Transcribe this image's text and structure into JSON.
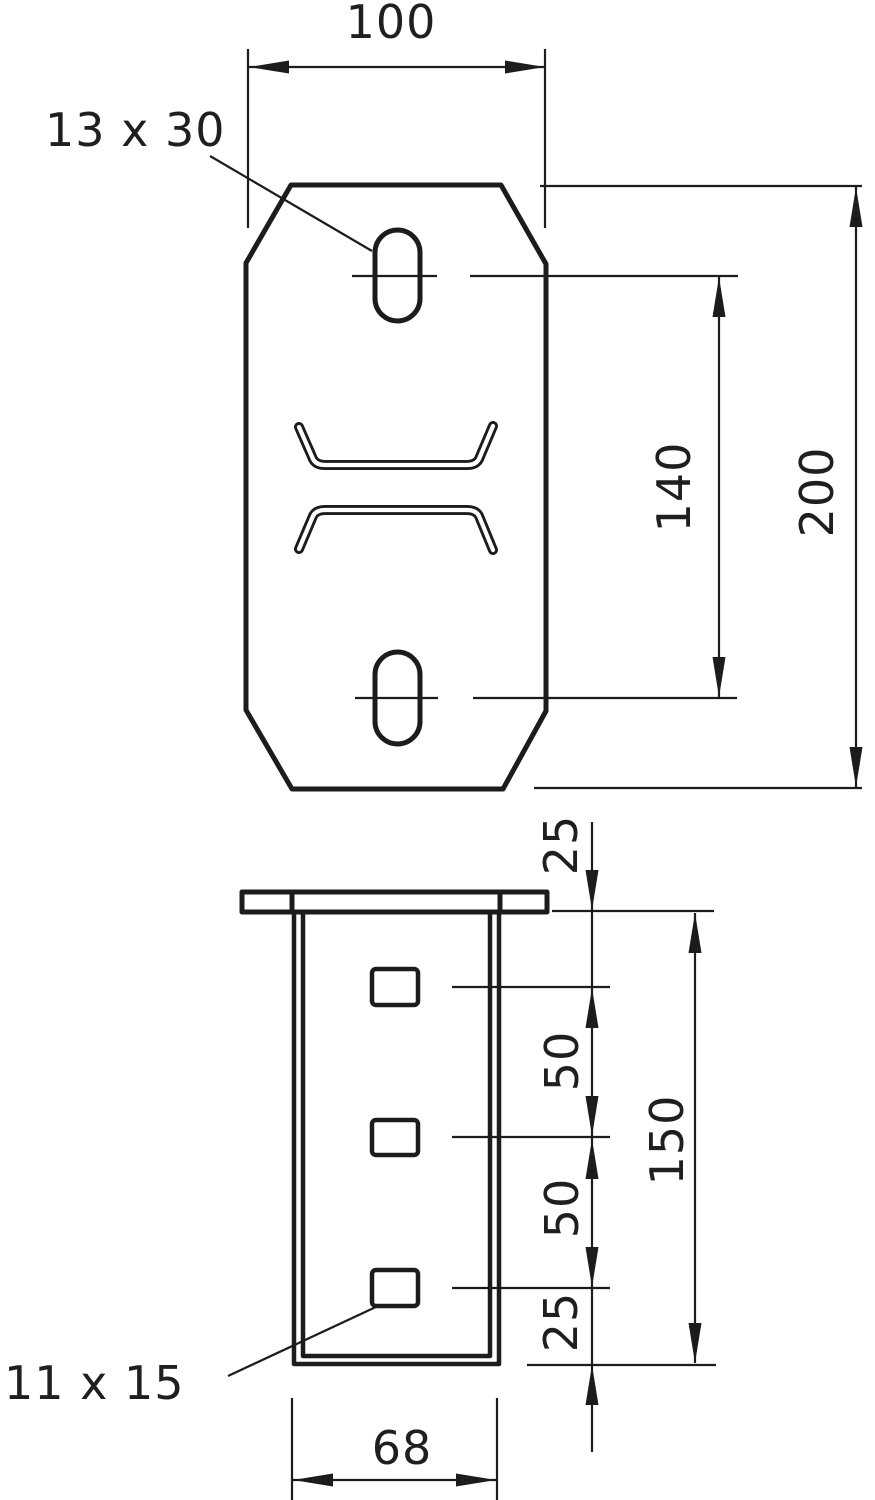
{
  "drawing": {
    "type": "technical-drawing",
    "colors": {
      "background": "#ffffff",
      "line": "#1c1c1c"
    },
    "front_view": {
      "width_dim": "100",
      "height_dim": "200",
      "slot_spacing_dim": "140",
      "slot_size_label": "13 x 30"
    },
    "side_view": {
      "top_offset_dim": "25",
      "hole_spacing_dim_1": "50",
      "hole_spacing_dim_2": "50",
      "bottom_offset_dim": "25",
      "height_dim": "150",
      "width_dim": "68",
      "hole_size_label": "11 x 15"
    }
  }
}
